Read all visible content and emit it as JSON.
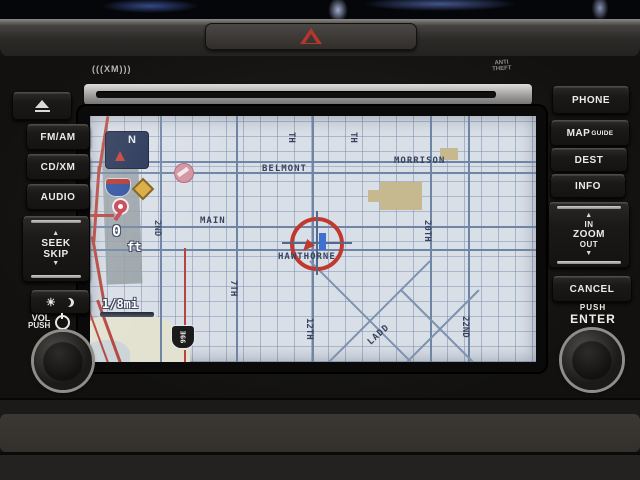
{
  "top": {
    "xm_label": "(((XM)))",
    "anti_theft_line1": "ANTI",
    "anti_theft_line2": "THEFT"
  },
  "left_panel": {
    "fm_am": "FM/AM",
    "cd_xm": "CD/XM",
    "audio": "AUDIO",
    "seek": "SEEK",
    "skip": "SKIP",
    "seek_up": "▲",
    "seek_down": "▼",
    "dimmer_sun": "☀",
    "vol": "VOL",
    "vol_push": "PUSH"
  },
  "right_panel": {
    "phone": "PHONE",
    "map": "MAP",
    "guide": "GUIDE",
    "dest": "DEST",
    "info": "INFO",
    "zoom_up": "▲",
    "zoom_in": "IN",
    "zoom": "ZOOM",
    "zoom_out": "OUT",
    "zoom_down": "▼",
    "cancel": "CANCEL",
    "push": "PUSH",
    "enter": "ENTER"
  },
  "map": {
    "compass": "N",
    "streets": {
      "belmont": "BELMONT",
      "morrison": "MORRISON",
      "main": "MAIN",
      "hawthorne": "HAWTHORNE",
      "second": "2ND",
      "seventh": "7TH",
      "twelfth": "12TH",
      "twentieth": "20TH",
      "twenty_second": "22ND",
      "cut_top_1": "TH",
      "cut_top_2": "TH",
      "ladd": "LADD"
    },
    "scale": "1/8mi",
    "distance_value": "0",
    "distance_unit": "ft",
    "route_shield": "99E"
  },
  "colors": {
    "map_bg": "#d9dfe7",
    "route_red": "#b5453e",
    "target_red": "#c0392f",
    "label_navy": "#39425e",
    "building_tan": "#c6b98f"
  }
}
